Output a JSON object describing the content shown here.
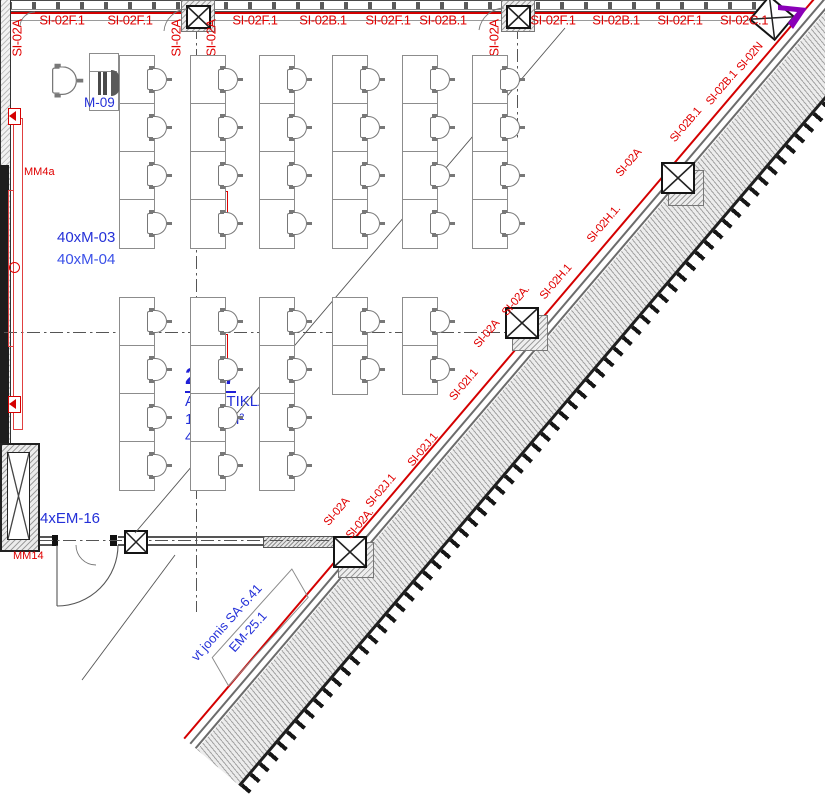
{
  "room": {
    "number": "2017",
    "name": "ARVUTIKLASS",
    "area": "179,6 m²",
    "seats": "40"
  },
  "equipment_labels": {
    "teacher_station": "M-09",
    "desk_group_a": "40xM-03",
    "desk_group_b": "40xM-04",
    "left_wall_device": "MM4a",
    "shaft_device": "MM14",
    "exit_device": "4xEM-16"
  },
  "reference_note": {
    "line1": "vt joonis SA-6.41",
    "line2": "EM-25.1"
  },
  "colors": {
    "circuit_red": "#e00000",
    "annotation_blue": "#2430d8",
    "marker_purple": "#8a00b8"
  },
  "top_wall_labels": [
    {
      "text": "SI-02F.1",
      "x": 62
    },
    {
      "text": "SI-02F.1",
      "x": 130
    },
    {
      "text": "SI-02F.1",
      "x": 255
    },
    {
      "text": "SI-02B.1",
      "x": 323
    },
    {
      "text": "SI-02F.1",
      "x": 388
    },
    {
      "text": "SI-02B.1",
      "x": 443
    },
    {
      "text": "SI-02F.1",
      "x": 553
    },
    {
      "text": "SI-02B.1",
      "x": 616
    },
    {
      "text": "SI-02F.1",
      "x": 680
    },
    {
      "text": "SI-02C.1",
      "x": 744
    }
  ],
  "top_wall_labels_vertical": [
    {
      "text": "SI-02A",
      "x": 17,
      "y": 38
    },
    {
      "text": "SI-02A",
      "x": 176,
      "y": 38
    },
    {
      "text": "SI-02A",
      "x": 211,
      "y": 38
    },
    {
      "text": "SI-02A",
      "x": 494,
      "y": 38
    }
  ],
  "diagonal_wall_labels": [
    {
      "text": "SI-02A.",
      "x": 360,
      "y": 524
    },
    {
      "text": "SI-02A",
      "x": 337,
      "y": 512
    },
    {
      "text": "SI-02J.1",
      "x": 381,
      "y": 491
    },
    {
      "text": "SI-02J.1",
      "x": 423,
      "y": 450
    },
    {
      "text": "SI-02I.1",
      "x": 464,
      "y": 385
    },
    {
      "text": "SI-02A",
      "x": 487,
      "y": 334
    },
    {
      "text": "SI-02A.",
      "x": 516,
      "y": 301
    },
    {
      "text": "SI-02H.1",
      "x": 556,
      "y": 282
    },
    {
      "text": "SI-02H.1.",
      "x": 604,
      "y": 224
    },
    {
      "text": "SI-02A",
      "x": 629,
      "y": 163
    },
    {
      "text": "SI-02B.1",
      "x": 686,
      "y": 125
    },
    {
      "text": "SI-02B.1",
      "x": 722,
      "y": 88
    },
    {
      "text": "SI-02N",
      "x": 750,
      "y": 57
    }
  ],
  "desks": {
    "upper": {
      "cols": [
        119,
        190,
        259,
        332,
        402,
        472
      ],
      "rows": [
        55,
        103,
        151,
        199
      ],
      "w": 34,
      "h": 48,
      "col_rows": [
        4,
        4,
        4,
        4,
        4,
        4
      ]
    },
    "lower": {
      "cols": [
        119,
        190,
        259,
        332,
        402
      ],
      "rows": [
        297,
        345,
        393,
        441
      ],
      "w": 34,
      "h": 48,
      "col_rows": [
        4,
        4,
        4,
        2,
        2
      ]
    }
  }
}
